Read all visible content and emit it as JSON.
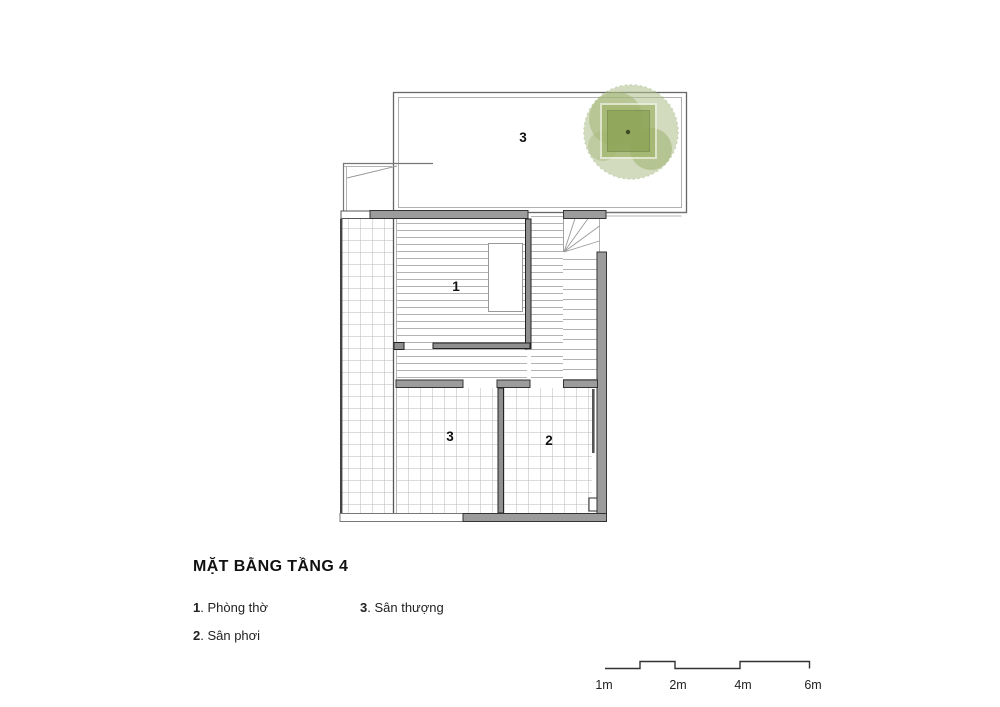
{
  "title": "MẶT BẰNG TẦNG 4",
  "legend": {
    "item1": {
      "num": "1",
      "text": ". Phòng thờ"
    },
    "item2": {
      "num": "2",
      "text": ". Sân phơi"
    },
    "item3": {
      "num": "3",
      "text": ". Sân thượng"
    }
  },
  "plan_labels": {
    "terrace": "3",
    "room1": "1",
    "room3": "3",
    "room2": "2"
  },
  "scale": {
    "l1": "1m",
    "l2": "2m",
    "l3": "4m",
    "l4": "6m"
  },
  "colors": {
    "wall_grey": "#9c9c9c",
    "wall_dark": "#8f8f8f",
    "wall_outline": "#333333",
    "floor_line": "#b3b3b3",
    "tree_green": "#9fb468",
    "planter_green": "#8ba254",
    "text": "#111111"
  }
}
